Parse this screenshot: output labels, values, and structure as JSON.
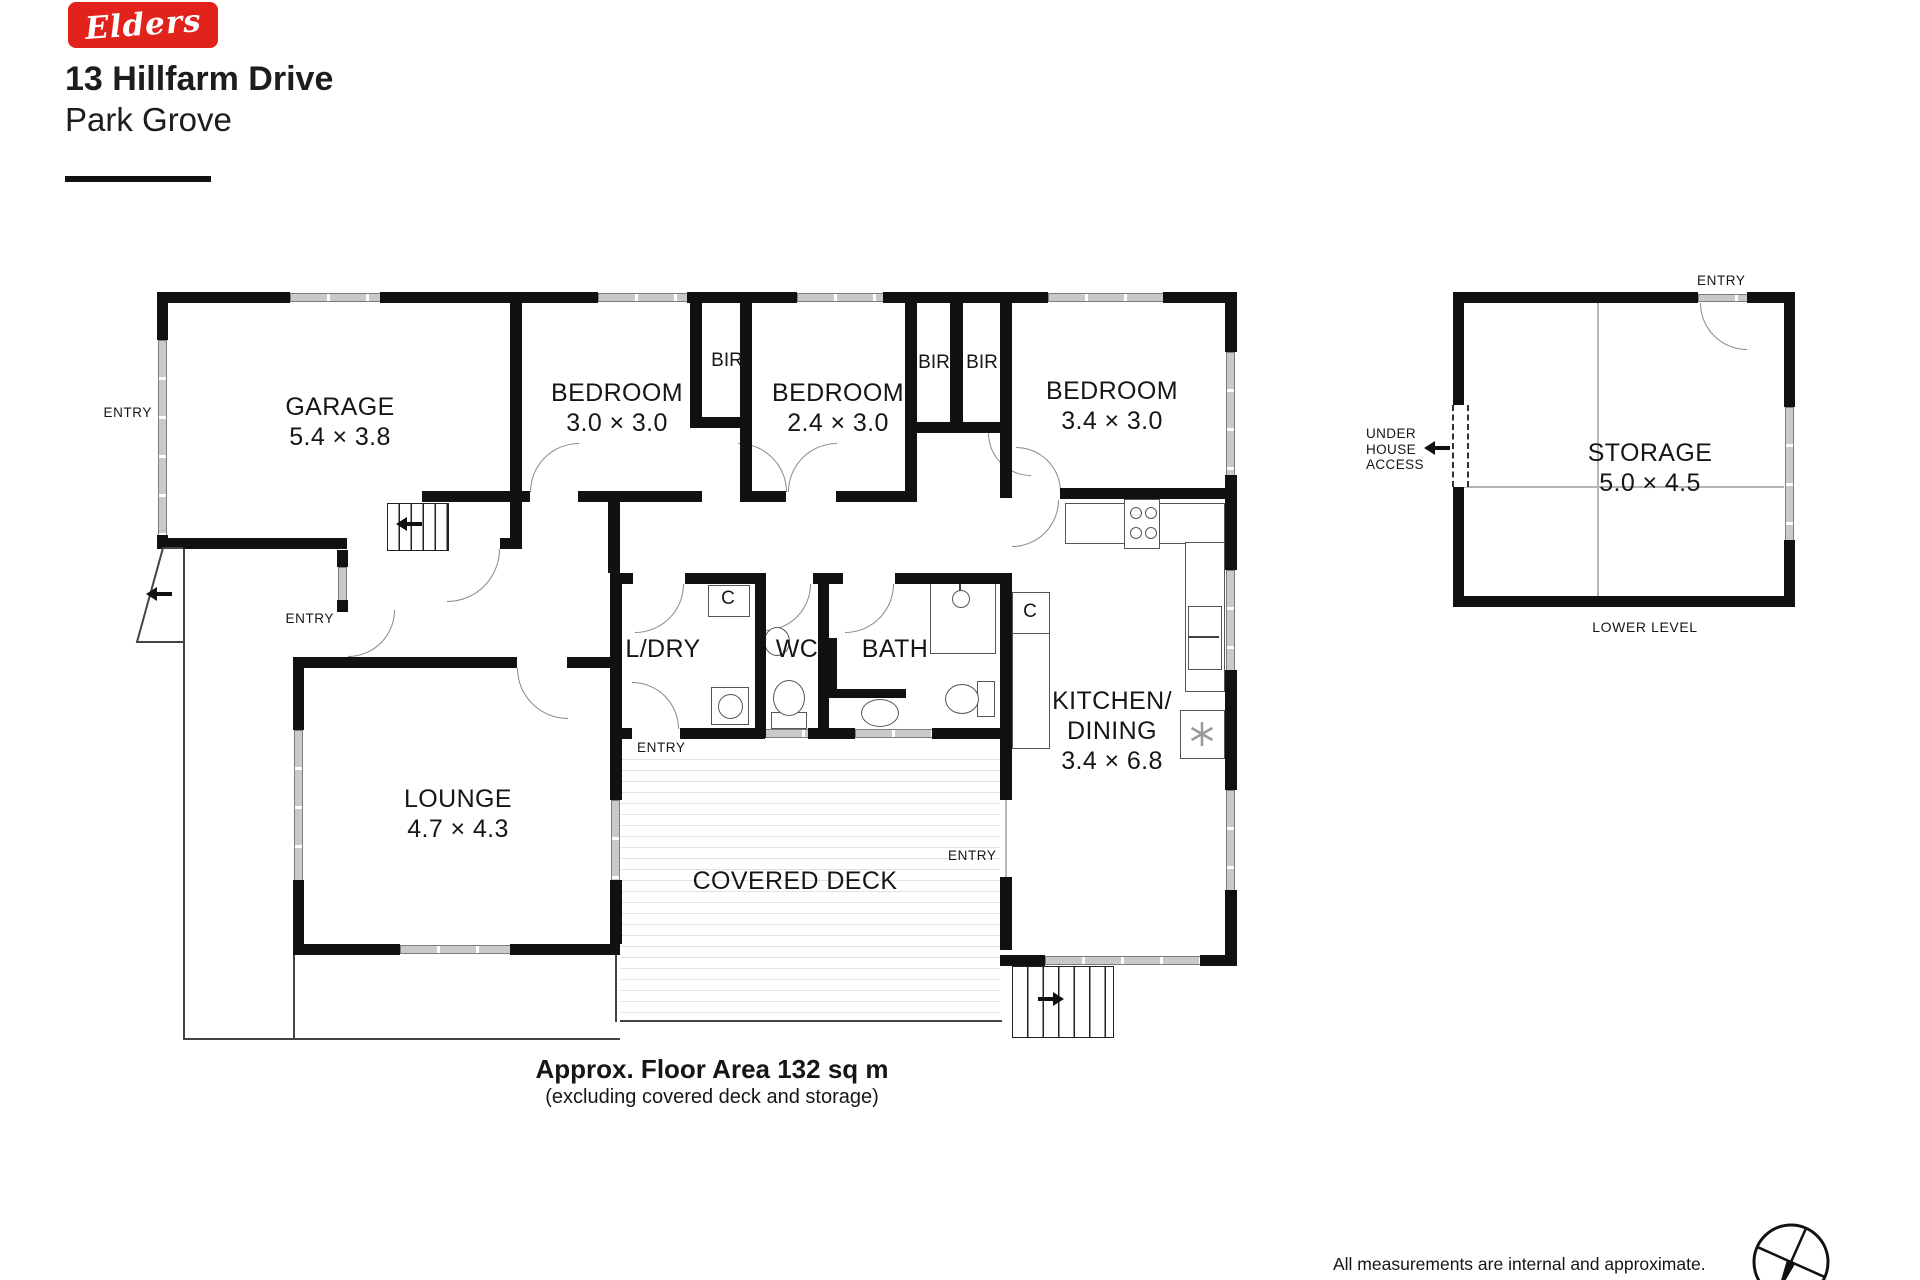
{
  "branding": {
    "logo_text": "Elders",
    "logo_color": "#e2231b"
  },
  "header": {
    "address_line1": "13 Hillfarm Drive",
    "address_line2": "Park Grove"
  },
  "rooms": {
    "garage": {
      "name": "GARAGE",
      "dims": "5.4 × 3.8"
    },
    "bedroom1": {
      "name": "BEDROOM",
      "dims": "3.0 × 3.0"
    },
    "bedroom2": {
      "name": "BEDROOM",
      "dims": "2.4 × 3.0"
    },
    "bedroom3": {
      "name": "BEDROOM",
      "dims": "3.4 × 3.0"
    },
    "laundry": {
      "name": "L/DRY"
    },
    "wc": {
      "name": "WC"
    },
    "bath": {
      "name": "BATH"
    },
    "kitchen": {
      "name_line1": "KITCHEN/",
      "name_line2": "DINING",
      "dims": "3.4 × 6.8"
    },
    "lounge": {
      "name": "LOUNGE",
      "dims": "4.7 × 4.3"
    },
    "covered_deck": {
      "name": "COVERED DECK"
    },
    "storage": {
      "name": "STORAGE",
      "dims": "5.0 × 4.5"
    }
  },
  "labels": {
    "entry": "ENTRY",
    "bir": "BIR",
    "closet": "C",
    "under_house_access": [
      "UNDER",
      "HOUSE",
      "ACCESS"
    ],
    "lower_level": "LOWER LEVEL"
  },
  "footer": {
    "floor_area": "Approx. Floor Area 132 sq m",
    "floor_area_note": "(excluding covered deck and storage)",
    "disclaimer_line1": "All measurements are internal and approximate.",
    "disclaimer_line2": "This plan is for illustrative purposes only."
  }
}
